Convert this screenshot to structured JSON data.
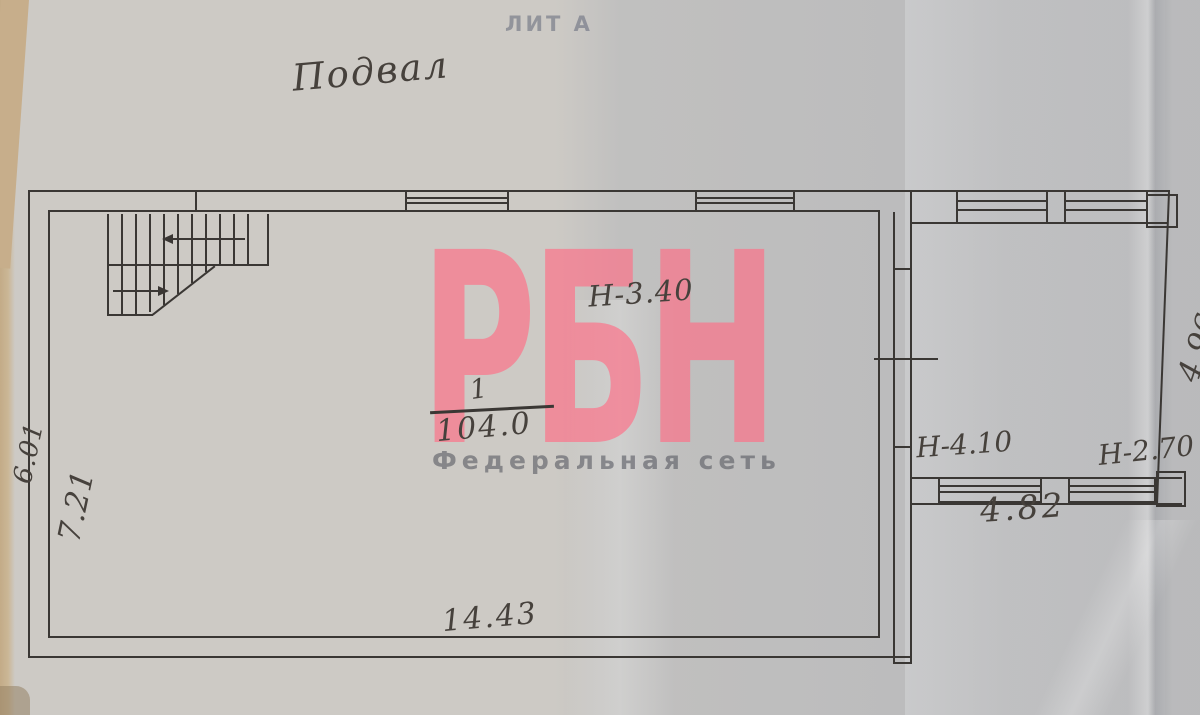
{
  "page": {
    "lit_label": "ЛИТ А",
    "floor_title": "Подвал"
  },
  "watermark": {
    "logo_text": "РБН",
    "subtitle": "Федеральная  сеть",
    "logo_color": "#fd7088",
    "subtitle_color": "#5a5c64"
  },
  "main_room": {
    "height_label": "Н-3.40",
    "room_number": "1",
    "area_value": "104.0",
    "width_dim": "14.43",
    "inner_depth_dim": "7.21",
    "outer_depth_dim": "6.01"
  },
  "right_room": {
    "left_height_label": "Н-4.10",
    "right_height_label": "Н-2.70",
    "width_dim": "4.82",
    "right_edge_dim": "4.96"
  },
  "colors": {
    "ink": "#3a3734",
    "pencil": "#46413c",
    "paper": "#cdcac5"
  }
}
